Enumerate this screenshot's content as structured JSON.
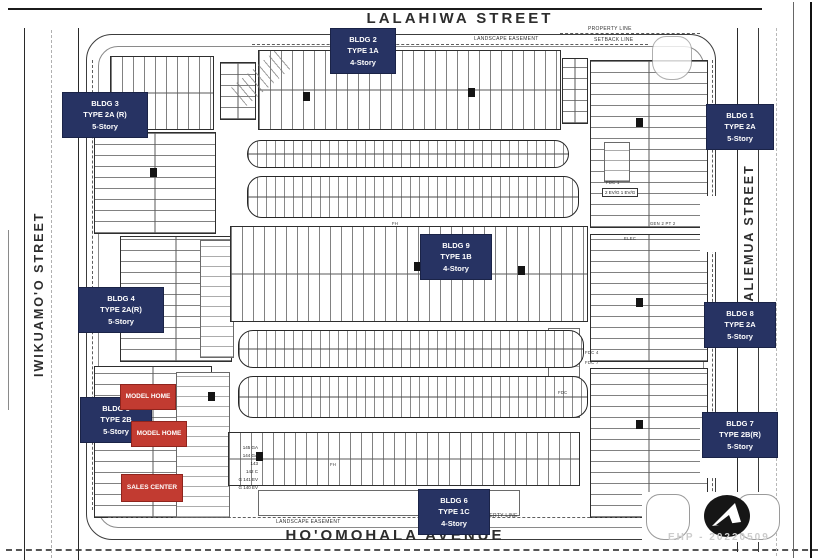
{
  "colors": {
    "label_navy": "#273363",
    "label_red": "#c23b31",
    "line_dark": "#1b1b1b"
  },
  "streets": {
    "north": "LALAHIWA STREET",
    "south": "HO'OMOHALA AVENUE",
    "west": "IWIKUAMO'O STREET",
    "east": "KAMALIEMUA STREET"
  },
  "buildings": [
    {
      "name": "BLDG 1",
      "type": "TYPE 2A",
      "story": "5-Story"
    },
    {
      "name": "BLDG 2",
      "type": "TYPE 1A",
      "story": "4-Story"
    },
    {
      "name": "BLDG 3",
      "type": "TYPE 2A (R)",
      "story": "5-Story"
    },
    {
      "name": "BLDG 4",
      "type": "TYPE 2A(R)",
      "story": "5-Story"
    },
    {
      "name": "BLDG 5",
      "type": "TYPE 2B",
      "story": "5-Story"
    },
    {
      "name": "BLDG 6",
      "type": "TYPE 1C",
      "story": "4-Story"
    },
    {
      "name": "BLDG 7",
      "type": "TYPE 2B(R)",
      "story": "5-Story"
    },
    {
      "name": "BLDG 8",
      "type": "TYPE 2A",
      "story": "5-Story"
    },
    {
      "name": "BLDG 9",
      "type": "TYPE 1B",
      "story": "4-Story"
    }
  ],
  "markers": {
    "model_home": "MODEL HOME",
    "sales_center": "SALES CENTER"
  },
  "annotations": {
    "landscape_easement": "LANDSCAPE EASEMENT",
    "property_line": "PROPERTY LINE",
    "setback_line": "SETBACK LINE",
    "fdc1": "FDC 1",
    "fdc": "FDC",
    "fdc4": "FDC 4",
    "fdc7": "FDC 7",
    "ev_garage": "2 EV/G 1 EV/G",
    "elec": "ELEC",
    "fh": "FH",
    "gen": "GEN 2 PT 2"
  },
  "unit_labels": [
    "145 GA",
    "144 GA",
    "143",
    "142 C",
    "G 141 EV",
    "G 140 EV"
  ],
  "watermark": "EHP - 20220509",
  "icons": {
    "logo": "arrow-in-circle-logo"
  }
}
